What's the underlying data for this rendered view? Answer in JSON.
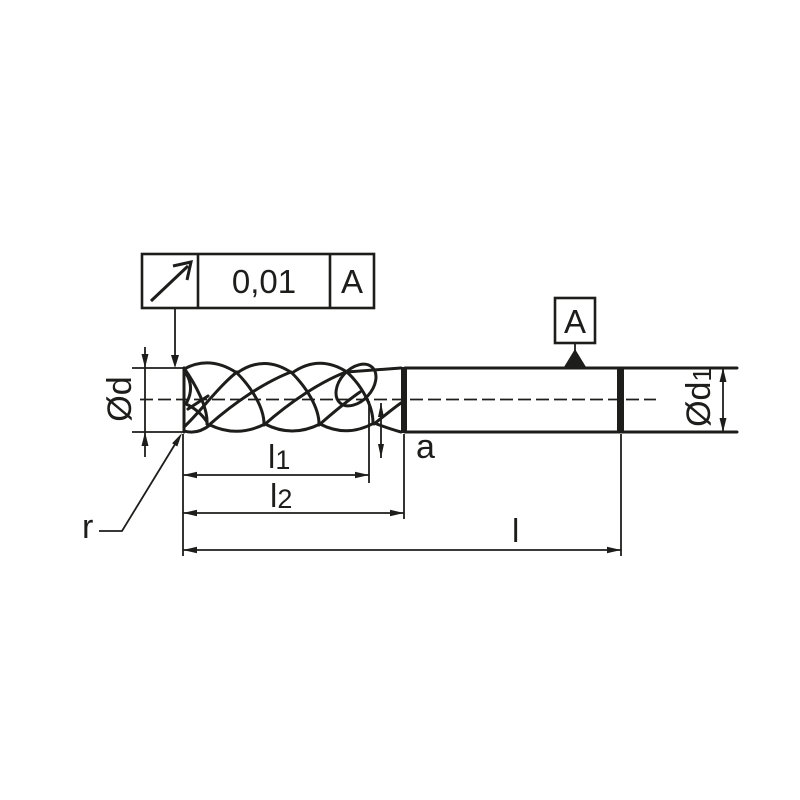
{
  "tolerance_frame": {
    "symbol_icon": "circular-runout-arrow",
    "value": "0,01",
    "datum_ref": "A"
  },
  "datum_flag": {
    "label": "A"
  },
  "dimension_labels": {
    "d": "Ød",
    "d1_base": "Ød",
    "d1_sub": "1",
    "l1_base": "l",
    "l1_sub": "1",
    "l2_base": "l",
    "l2_sub": "2",
    "l": "l",
    "a": "a",
    "r": "r"
  },
  "colors": {
    "ink": "#1d1d1b",
    "background": "#ffffff"
  }
}
